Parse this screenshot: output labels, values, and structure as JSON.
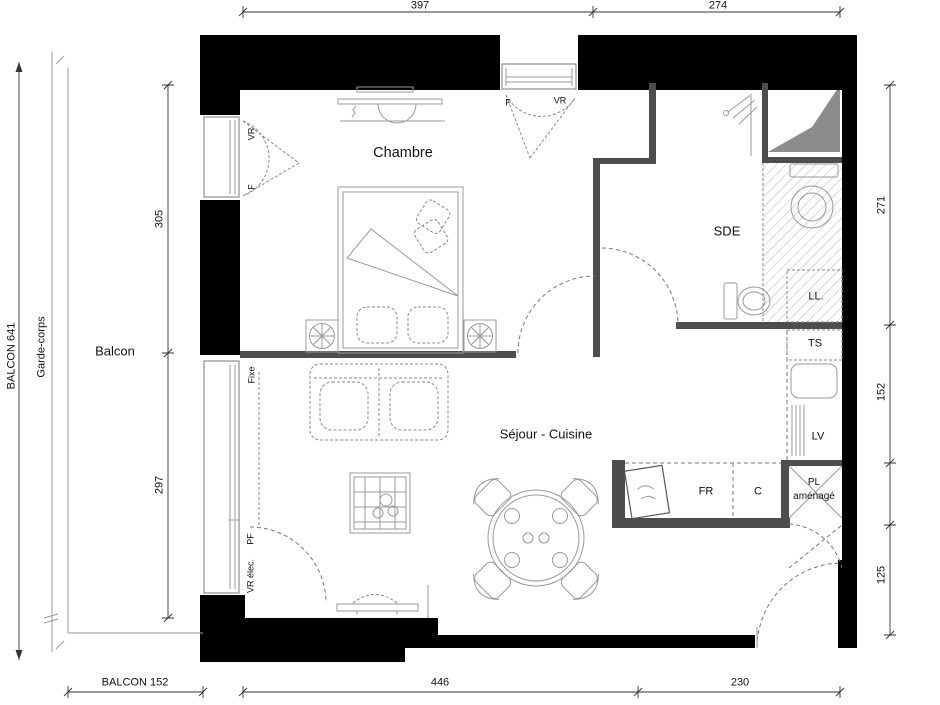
{
  "rooms": {
    "chambre": "Chambre",
    "sde": "SDE",
    "sejour_cuisine": "Séjour - Cuisine",
    "balcon": "Balcon"
  },
  "fixtures": {
    "ll": "LL.",
    "ts": "TS",
    "lv": "LV",
    "fr": "FR",
    "c": "C",
    "pl_line1": "PL",
    "pl_line2": "aménagé"
  },
  "openings": {
    "window_top_f": "F",
    "window_top_vr": "VR",
    "window_chambre_vr": "VR",
    "window_chambre_f": "F",
    "window_sejour_fixe": "Fixe",
    "window_sejour_pf": "PF",
    "window_sejour_vr_elec": "VR élec."
  },
  "dimensions": {
    "top_chambre": "397",
    "top_sde": "274",
    "left_chambre": "305",
    "left_sejour": "297",
    "right_sde": "271",
    "right_kitchen": "152",
    "right_entry": "125",
    "bottom_balcon": "BALCON 152",
    "bottom_sejour": "446",
    "bottom_entry": "230",
    "balcon_height": "BALCON 641",
    "garde_corps": "Garde-corps"
  },
  "colors": {
    "wall": "#000000",
    "partition": "#4d4d4d",
    "furniture": "#9a9a9a",
    "dashed": "#8a8a8a",
    "hatch": "#b4b4b4",
    "shaft": "#8c8c8c",
    "dimension": "#333333",
    "background": "#ffffff"
  }
}
